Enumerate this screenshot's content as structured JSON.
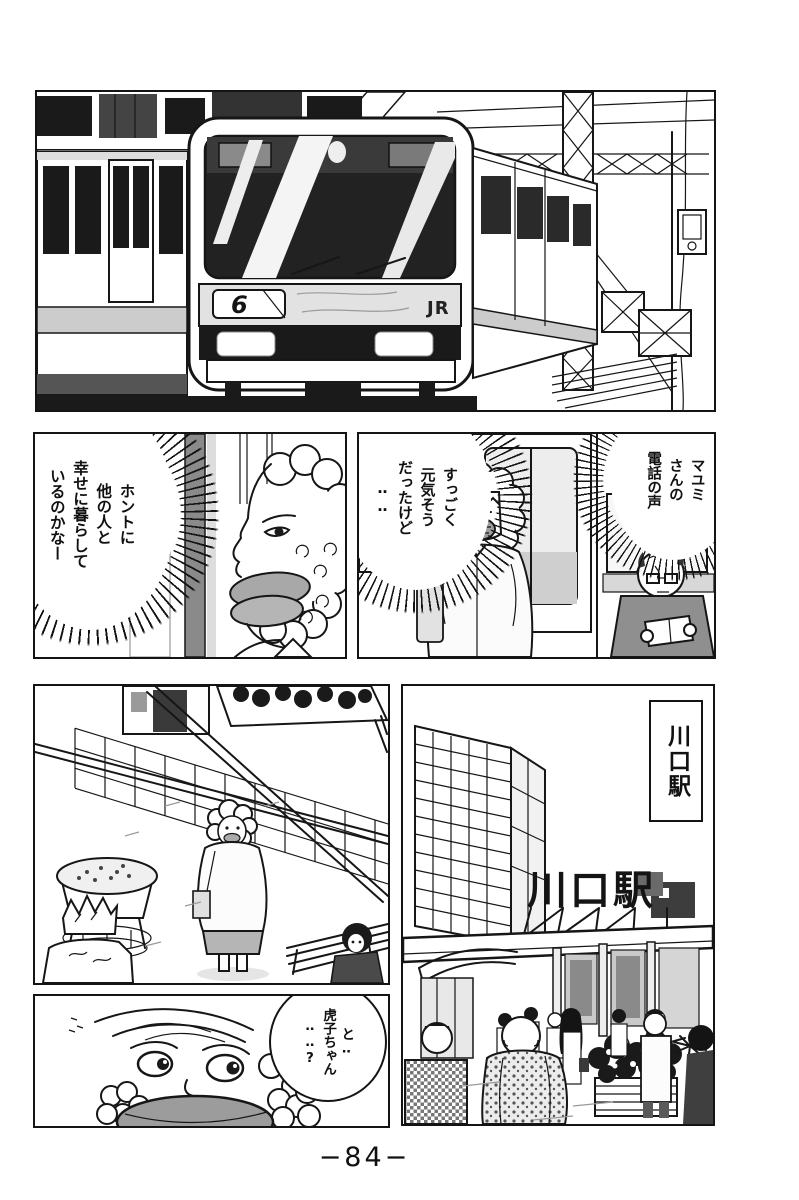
{
  "page": {
    "number": "−84−"
  },
  "panel1": {
    "destination_number": "6",
    "jr_logo": "JR"
  },
  "panel2": {
    "bubble": "ホントに\n他の人と\n幸せに暮らして\nいるのかなー"
  },
  "panel3": {
    "bubble_monologue": "すっごく\n元気そう\nだったけど\n‥‥",
    "bubble_caption": "マユミ\nさんの\n電話の声"
  },
  "panel5": {
    "station_caption": "川口駅",
    "roof_sign": "川口駅"
  },
  "panel6": {
    "bubble": "と‥\n虎子ちゃん\n‥‥?"
  }
}
